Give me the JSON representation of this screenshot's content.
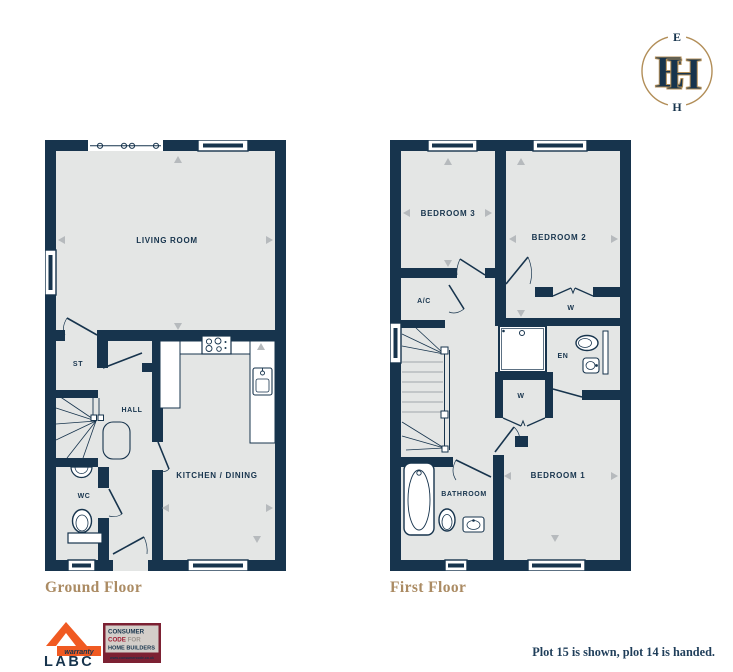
{
  "brand_logo": {
    "top_letter": "E",
    "bottom_letter": "H",
    "color": "#b28e58"
  },
  "plans": {
    "ground": {
      "title": "Ground Floor",
      "rooms": {
        "living_room": "LIVING ROOM",
        "store": "ST",
        "hall": "HALL",
        "wc": "WC",
        "kitchen_dining": "KITCHEN / DINING"
      }
    },
    "first": {
      "title": "First Floor",
      "rooms": {
        "bedroom_3": "BEDROOM 3",
        "bedroom_2": "BEDROOM 2",
        "airing_cupboard": "A/C",
        "wardrobe_bedroom_2": "W",
        "ensuite": "EN",
        "wardrobe_landing": "W",
        "bedroom_1": "BEDROOM 1",
        "bathroom": "BATHROOM"
      }
    }
  },
  "footer": {
    "labc": {
      "warranty_label": "warranty",
      "brand": "LABC"
    },
    "consumer_code": {
      "line1": "CONSUMER",
      "line2_strong": "CODE",
      "line2_rest": " FOR",
      "line3": "HOME BUILDERS",
      "url": "www.consumercode.co.uk"
    },
    "plot_note": "Plot 15 is shown, plot 14 is handed."
  },
  "colors": {
    "wall_navy": "#17344d",
    "floor_grey": "#e4e6e5",
    "accent_gold": "#b28e58",
    "title_tan": "#ab8b63",
    "labc_orange": "#f05a22",
    "consumer_maroon": "#7c2133"
  }
}
